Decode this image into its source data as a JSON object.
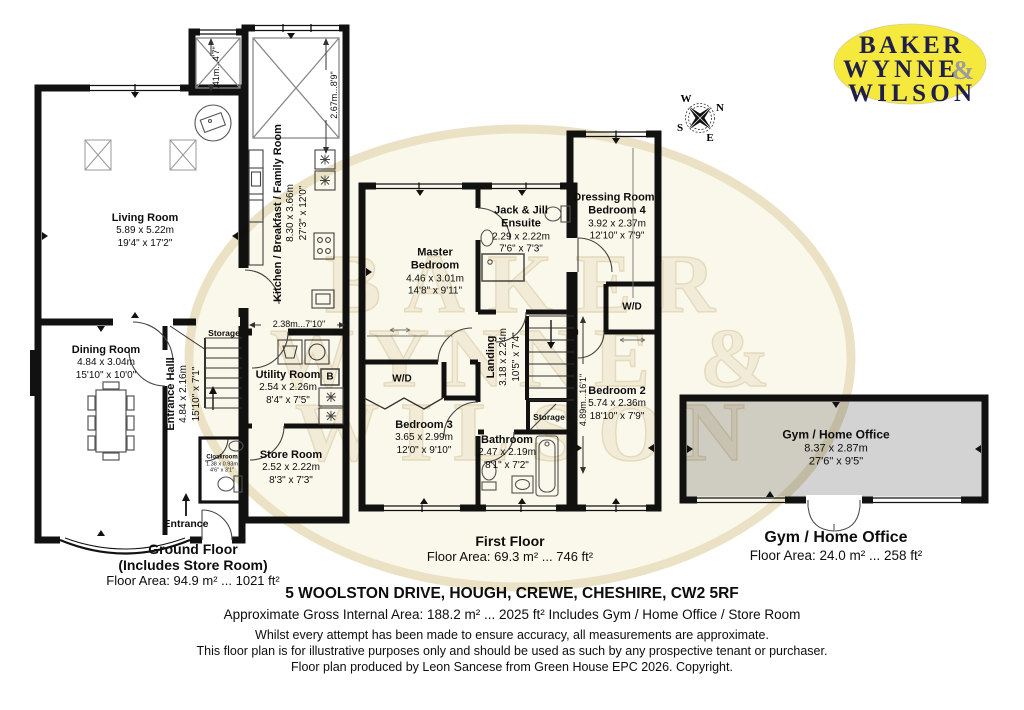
{
  "logo": {
    "line1": "BAKER",
    "line2": "WYNNE",
    "ampersand": "&",
    "line3": "WILSON"
  },
  "watermark": {
    "line1": "BAKER",
    "line2": "WYNNE &",
    "line3": "WILSON"
  },
  "compass": {
    "north": "N",
    "south": "S",
    "east": "E",
    "west": "W"
  },
  "rooms": {
    "living": {
      "name": "Living Room",
      "metric": "5.89 x 5.22m",
      "imperial": "19'4\" x 17'2\""
    },
    "kitchen": {
      "name": "Kitchen / Breakfast / Family Room",
      "metric": "8.30 x 3.66m",
      "imperial": "27'3\" x 12'0\""
    },
    "dining": {
      "name": "Dining Room",
      "metric": "4.84 x 3.04m",
      "imperial": "15'10\" x 10'0\""
    },
    "hall": {
      "name": "Entrance Halll",
      "metric": "4.84 x 2.16m",
      "imperial": "15'10\" x 7'1\""
    },
    "utility": {
      "name": "Utility Room",
      "metric": "2.54 x 2.26m",
      "imperial": "8'4\" x 7'5\""
    },
    "store": {
      "name": "Store Room",
      "metric": "2.52 x 2.22m",
      "imperial": "8'3\" x 7'3\""
    },
    "cloak": {
      "name": "Cloakroom",
      "metric": "1.38 x 0.93m",
      "imperial": "4'6\" x 3'1\""
    },
    "master": {
      "name": "Master Bedroom",
      "metric": "4.46 x 3.01m",
      "imperial": "14'8\" x 9'11\""
    },
    "ensuite": {
      "name": "Jack & Jill Ensuite",
      "metric": "2.29 x 2.22m",
      "imperial": "7'6\" x 7'3\""
    },
    "dressing": {
      "name": "Dressing Room / Bedroom 4",
      "metric": "3.92 x 2.37m",
      "imperial": "12'10\" x 7'9\""
    },
    "landing": {
      "name": "Landing",
      "metric": "3.18 x 2.24m",
      "imperial": "10'5\" x 7'4\""
    },
    "bed2": {
      "name": "Bedroom 2",
      "metric": "5.74 x 2.36m",
      "imperial": "18'10\" x 7'9\""
    },
    "bed3": {
      "name": "Bedroom 3",
      "metric": "3.65 x 2.99m",
      "imperial": "12'0\" x 9'10\""
    },
    "bathroom": {
      "name": "Bathroom",
      "metric": "2.47 x 2.19m",
      "imperial": "8'1\" x 7'2\""
    },
    "gym": {
      "name": "Gym / Home Office",
      "metric": "8.37 x 2.87m",
      "imperial": "27'6\" x 9'5\""
    }
  },
  "labels": {
    "storage": "Storage",
    "wd": "W/D",
    "boiler": "B",
    "entrance": "Entrance"
  },
  "dims": {
    "kitchen_width": "2.38m...7'10\"",
    "rear_projection": "1.41m...4'7\"",
    "kitchen_rear_depth": "2.67m...8'9\"",
    "bedroom2_length": "4.89m...16'1\""
  },
  "captions": {
    "ground": {
      "title": "Ground Floor",
      "subtitle": "(Includes Store Room)",
      "area": "Floor Area: 94.9 m² ... 1021 ft²"
    },
    "first": {
      "title": "First Floor",
      "area": "Floor Area: 69.3 m² ... 746 ft²"
    },
    "gym": {
      "title": "Gym / Home Office",
      "area": "Floor Area: 24.0 m² ... 258 ft²"
    }
  },
  "footer": {
    "address": "5 WOOLSTON DRIVE, HOUGH, CREWE, CHESHIRE, CW2 5RF",
    "gross_area": "Approximate Gross Internal Area: 188.2 m² ... 2025 ft² Includes Gym / Home Office / Store Room",
    "disclaimer1": "Whilst every attempt has been made to ensure accuracy, all measurements are approximate.",
    "disclaimer2": "This floor plan is for illustrative purposes only and should be used as such by any prospective tenant or purchaser.",
    "credit": "Floor plan produced by Leon Sancese from Green House EPC 2026. Copyright."
  },
  "colors": {
    "logo_bg": "#F4E93C",
    "logo_text": "#201F4B",
    "logo_amp": "#9C9CA0",
    "wall": "#111111",
    "gym_fill": "#D3D3D3",
    "watermark_fill": "#F2EBD8"
  }
}
